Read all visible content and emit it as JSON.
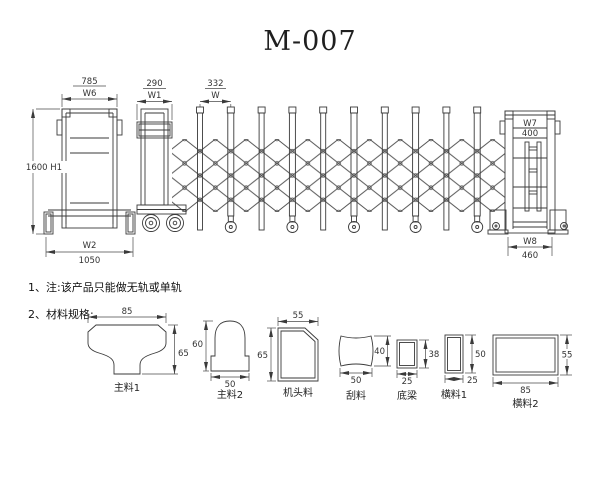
{
  "title": "M-007",
  "line_color": "#3a3a3a",
  "drawing": {
    "left_post": {
      "top_value": "785",
      "top_label": "W6",
      "height_label": "1600 H1",
      "bottom_label": "W2",
      "bottom_value": "1050"
    },
    "head_unit": {
      "top_value": "290",
      "top_label": "W1"
    },
    "bay": {
      "top_value": "332",
      "top_label": "W"
    },
    "tail_post": {
      "inner_label": "W7",
      "inner_value": "400",
      "bottom_label": "W8",
      "bottom_value": "460"
    }
  },
  "notes": {
    "note1": "1、注:该产品只能做无轨或单轨",
    "note2": "2、材料规格:"
  },
  "profiles": [
    {
      "name": "主料1",
      "dims": {
        "top": "85",
        "right": "65"
      }
    },
    {
      "name": "主料2",
      "dims": {
        "left": "60",
        "bottom": "50"
      }
    },
    {
      "name": "机头料",
      "dims": {
        "top": "55",
        "left": "65"
      }
    },
    {
      "name": "刮料",
      "dims": {
        "right": "40",
        "bottom": "50"
      }
    },
    {
      "name": "底梁",
      "dims": {
        "right": "38",
        "bottom": "25"
      }
    },
    {
      "name": "横料1",
      "dims": {
        "right": "50",
        "bottom": "25"
      }
    },
    {
      "name": "横料2",
      "dims": {
        "right": "55",
        "bottom": "85"
      }
    }
  ]
}
